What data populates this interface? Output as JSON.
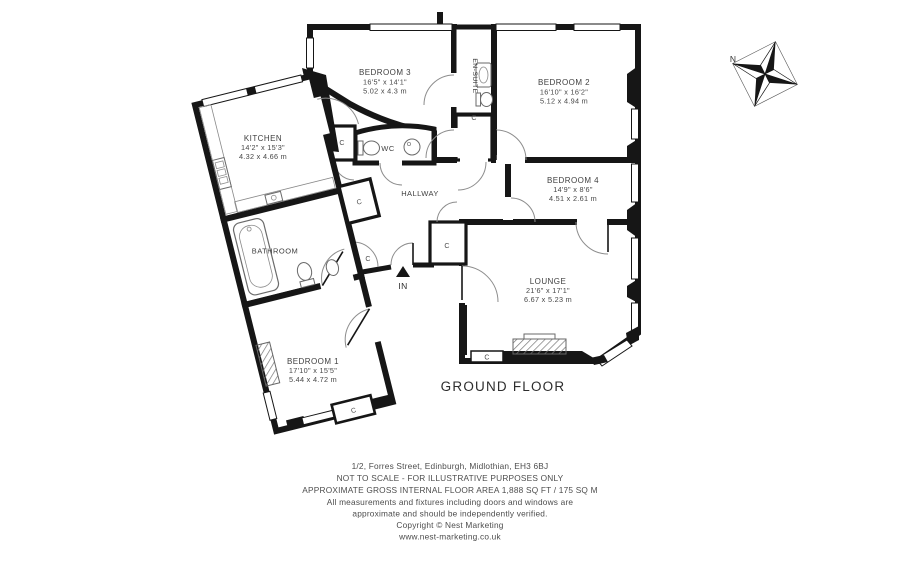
{
  "title": {
    "floor_label": "GROUND FLOOR"
  },
  "compass": {
    "north_label": "N"
  },
  "markers": {
    "entrance": "IN",
    "closet": "C"
  },
  "rooms": {
    "bedroom3": {
      "name": "BEDROOM 3",
      "imperial": "16'5\" x 14'1\"",
      "metric": "5.02 x 4.3 m"
    },
    "bedroom2": {
      "name": "BEDROOM 2",
      "imperial": "16'10\" x 16'2\"",
      "metric": "5.12 x 4.94 m"
    },
    "bedroom4": {
      "name": "BEDROOM 4",
      "imperial": "14'9\" x 8'6\"",
      "metric": "4.51 x 2.61 m"
    },
    "lounge": {
      "name": "LOUNGE",
      "imperial": "21'6\" x 17'1\"",
      "metric": "6.67 x 5.23 m"
    },
    "kitchen": {
      "name": "KITCHEN",
      "imperial": "14'2\" x 15'3\"",
      "metric": "4.32 x 4.66 m"
    },
    "bedroom1": {
      "name": "BEDROOM 1",
      "imperial": "17'10\" x 15'5\"",
      "metric": "5.44 x 4.72 m"
    },
    "bathroom": {
      "name": "BATHROOM"
    },
    "wc": {
      "name": "WC"
    },
    "ensuite": {
      "name": "EN-SUITE"
    },
    "hallway": {
      "name": "HALLWAY"
    }
  },
  "footer": {
    "lines": [
      "1/2, Forres Street, Edinburgh, Midlothian, EH3 6BJ",
      "NOT TO SCALE - FOR ILLUSTRATIVE PURPOSES ONLY",
      "APPROXIMATE GROSS INTERNAL FLOOR AREA 1,888 SQ FT / 175 SQ M",
      "All measurements and fixtures including doors and windows are",
      "approximate and should be independently verified.",
      "Copyright © Nest Marketing",
      "www.nest-marketing.co.uk"
    ]
  },
  "colors": {
    "wall": "#161616",
    "label_text": "#3f3f3f",
    "door_arc": "#8d8d8d"
  }
}
